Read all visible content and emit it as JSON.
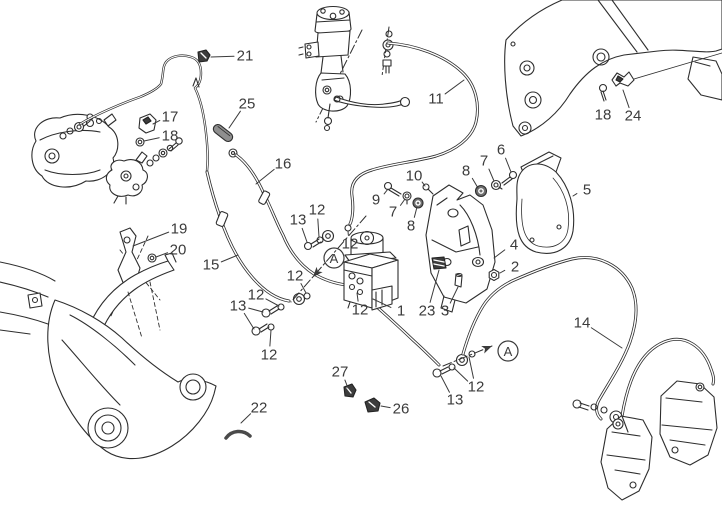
{
  "palette": {
    "background": "#ffffff",
    "line_color": "#2e2e2e",
    "label_color": "#3b3b3b",
    "sleeve_gray": "#8f8f8f",
    "clip_dark": "#3d3d3d"
  },
  "section_markers": [
    {
      "label": "A",
      "cx": 334,
      "cy": 258,
      "line": [
        366,
        216,
        291,
        302
      ],
      "arrow": [
        313,
        277,
        131
      ]
    },
    {
      "label": "A",
      "cx": 508,
      "cy": 351,
      "line": [
        443,
        366,
        492,
        346
      ],
      "arrow": [
        492,
        346,
        -22
      ]
    }
  ],
  "callouts": [
    {
      "label": "21",
      "x": 245,
      "y": 56,
      "leaders": [
        [
          211,
          57
        ]
      ]
    },
    {
      "label": "25",
      "x": 247,
      "y": 104,
      "leaders": [
        [
          229,
          128
        ]
      ]
    },
    {
      "label": "17",
      "x": 170,
      "y": 117,
      "leaders": [
        [
          153,
          124
        ]
      ]
    },
    {
      "label": "18",
      "x": 170,
      "y": 136,
      "leaders": [
        [
          144,
          141
        ]
      ]
    },
    {
      "label": "16",
      "x": 283,
      "y": 164,
      "leaders": [
        [
          256,
          184
        ]
      ]
    },
    {
      "label": "11",
      "x": 436,
      "y": 99,
      "leaders": [
        [
          464,
          80
        ]
      ]
    },
    {
      "label": "18",
      "x": 603,
      "y": 115,
      "leaders": []
    },
    {
      "label": "24",
      "x": 633,
      "y": 116,
      "leaders": [
        [
          623,
          90
        ]
      ]
    },
    {
      "label": "6",
      "x": 501,
      "y": 150,
      "leaders": [
        [
          511,
          172
        ]
      ]
    },
    {
      "label": "7",
      "x": 484,
      "y": 161,
      "leaders": [
        [
          494,
          181
        ]
      ]
    },
    {
      "label": "8",
      "x": 466,
      "y": 171,
      "leaders": [
        [
          478,
          188
        ]
      ]
    },
    {
      "label": "10",
      "x": 414,
      "y": 176,
      "leaders": [
        [
          425,
          186
        ]
      ]
    },
    {
      "label": "9",
      "x": 376,
      "y": 200,
      "leaders": [
        [
          388,
          189
        ]
      ]
    },
    {
      "label": "7",
      "x": 393,
      "y": 212,
      "leaders": [
        [
          405,
          199
        ]
      ]
    },
    {
      "label": "8",
      "x": 411,
      "y": 226,
      "leaders": [
        [
          417,
          207
        ]
      ]
    },
    {
      "label": "5",
      "x": 587,
      "y": 190,
      "leaders": [
        [
          573,
          196
        ]
      ]
    },
    {
      "label": "4",
      "x": 514,
      "y": 245,
      "leaders": [
        [
          494,
          258
        ]
      ]
    },
    {
      "label": "2",
      "x": 515,
      "y": 267,
      "leaders": [
        [
          500,
          273
        ]
      ]
    },
    {
      "label": "19",
      "x": 179,
      "y": 229,
      "leaders": [
        [
          133,
          246
        ]
      ]
    },
    {
      "label": "20",
      "x": 178,
      "y": 250,
      "leaders": [
        [
          156,
          257
        ]
      ]
    },
    {
      "label": "15",
      "x": 211,
      "y": 265,
      "leaders": [
        [
          238,
          255
        ]
      ]
    },
    {
      "label": "12",
      "x": 317,
      "y": 210,
      "leaders": [
        [
          319,
          237
        ]
      ]
    },
    {
      "label": "13",
      "x": 298,
      "y": 220,
      "leaders": [
        [
          307,
          242
        ]
      ]
    },
    {
      "label": "12",
      "x": 350,
      "y": 244,
      "leaders": [
        [
          348,
          231
        ]
      ]
    },
    {
      "label": "12",
      "x": 295,
      "y": 276,
      "leaders": [
        [
          306,
          293
        ]
      ]
    },
    {
      "label": "12",
      "x": 256,
      "y": 295,
      "leaders": [
        [
          279,
          306
        ]
      ]
    },
    {
      "label": "13",
      "x": 238,
      "y": 306,
      "leaders": [
        [
          263,
          312
        ],
        [
          254,
          329
        ]
      ]
    },
    {
      "label": "12",
      "x": 269,
      "y": 355,
      "leaders": [
        [
          271,
          330
        ]
      ]
    },
    {
      "label": "12",
      "x": 360,
      "y": 310,
      "leaders": [
        [
          357,
          293
        ]
      ]
    },
    {
      "label": "1",
      "x": 401,
      "y": 311,
      "leaders": [
        [
          373,
          299
        ]
      ]
    },
    {
      "label": "23",
      "x": 427,
      "y": 311,
      "leaders": [
        [
          439,
          270
        ]
      ]
    },
    {
      "label": "3",
      "x": 445,
      "y": 311,
      "leaders": [
        [
          458,
          287
        ]
      ]
    },
    {
      "label": "14",
      "x": 582,
      "y": 323,
      "leaders": [
        [
          622,
          348
        ]
      ]
    },
    {
      "label": "27",
      "x": 340,
      "y": 372,
      "leaders": [
        [
          348,
          388
        ]
      ]
    },
    {
      "label": "22",
      "x": 259,
      "y": 408,
      "leaders": [
        [
          241,
          423
        ]
      ]
    },
    {
      "label": "26",
      "x": 401,
      "y": 409,
      "leaders": [
        [
          381,
          406
        ]
      ]
    },
    {
      "label": "12",
      "x": 476,
      "y": 387,
      "leaders": [
        [
          454,
          368
        ],
        [
          469,
          357
        ]
      ]
    },
    {
      "label": "13",
      "x": 455,
      "y": 400,
      "leaders": [
        [
          441,
          376
        ]
      ]
    }
  ]
}
